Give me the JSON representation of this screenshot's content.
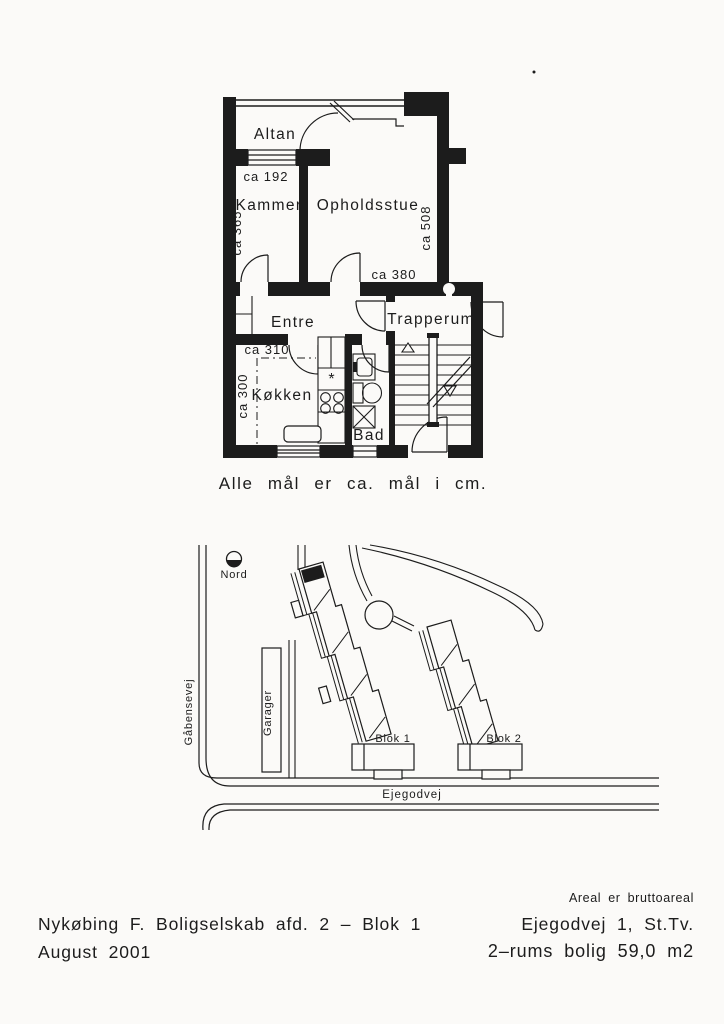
{
  "page": {
    "background": "#fbfaf8",
    "ink": "#1c1c1c"
  },
  "floor_plan": {
    "rooms": {
      "altan": "Altan",
      "kammer": "Kammer",
      "opholdsstue": "Opholdsstue",
      "entre": "Entre",
      "trapperum": "Trapperum",
      "kokken": "Køkken",
      "bad": "Bad"
    },
    "measurements": {
      "altan_window": "ca 192",
      "kammer_depth": "ca 365",
      "opholdsstue_depth": "ca 508",
      "opholdsstue_width": "ca 380",
      "kokken_width": "ca 310",
      "kokken_depth": "ca 300"
    },
    "stove_symbol": "*",
    "caption": "Alle mål er ca. mål i cm."
  },
  "site_plan": {
    "north_label": "Nord",
    "street_west": "Gåbensevej",
    "street_south": "Ejegodvej",
    "garages_label": "Garager",
    "block1_label": "Blok 1",
    "block2_label": "Blok 2"
  },
  "footer": {
    "company_line": "Nykøbing F. Boligselskab afd. 2 – Blok 1",
    "date_line": "August 2001",
    "area_note": "Areal er bruttoareal",
    "address": "Ejegodvej 1, St.Tv.",
    "unit_info": "2–rums bolig 59,0 m2"
  }
}
